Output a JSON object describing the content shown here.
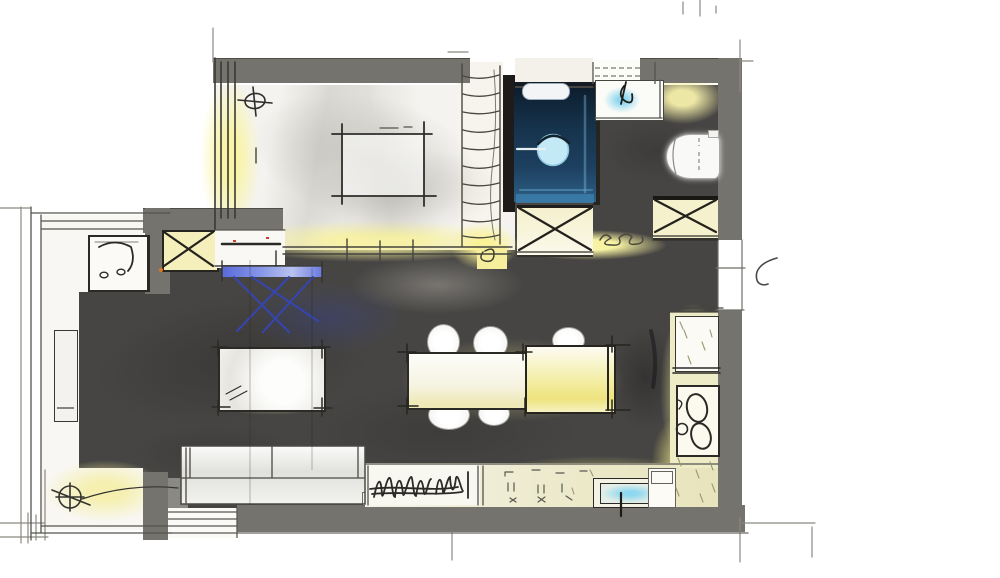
{
  "diagram": {
    "title": "Hand-drawn apartment floor plan sketch",
    "style": "marker and pen concept rendering, no text labels",
    "rooms": [
      {
        "id": "bedroom",
        "label": "Bedroom",
        "furniture": [
          "bed",
          "sliding-wardrobe",
          "dresser",
          "x-marked-cabinet",
          "ceiling-light-symbol"
        ]
      },
      {
        "id": "bathroom",
        "label": "Bathroom",
        "furniture": [
          "walk-in-shower",
          "washbasin",
          "toilet",
          "x-marked-vanity-cabinet",
          "tall-ladder-shelf"
        ]
      },
      {
        "id": "living-dining",
        "label": "Living / Dining Room",
        "furniture": [
          "blue-sketch-chair",
          "coffee-table",
          "dining-table",
          "dining-chairs",
          "sofa",
          "tv-console-with-scribbles"
        ]
      },
      {
        "id": "kitchen",
        "label": "Kitchen",
        "furniture": [
          "fridge-cabinet",
          "cooktop-and-sink-unit",
          "counter-with-sink"
        ]
      },
      {
        "id": "balcony",
        "label": "Balcony",
        "furniture": [
          "desk-with-chair",
          "planter-bench",
          "floor-drain-symbol"
        ]
      }
    ],
    "openings": [
      {
        "id": "entry-door",
        "label": "Entry door with swing arc",
        "wall": "right"
      },
      {
        "id": "balcony-door",
        "label": "Balcony sliding door",
        "wall": "bottom-left"
      },
      {
        "id": "window",
        "label": "Window above washbasin",
        "wall": "top"
      }
    ],
    "palette": {
      "wall_gray": "#75736d",
      "floor_dark": "#474543",
      "floor_light": "#f4f3ef",
      "glow_yellow": "#f7f1a2",
      "shower_navy": "#1d4060",
      "water_blue": "#8fd8ef",
      "sketch_blue": "#3646b5",
      "ink": "#2b2a26"
    }
  }
}
